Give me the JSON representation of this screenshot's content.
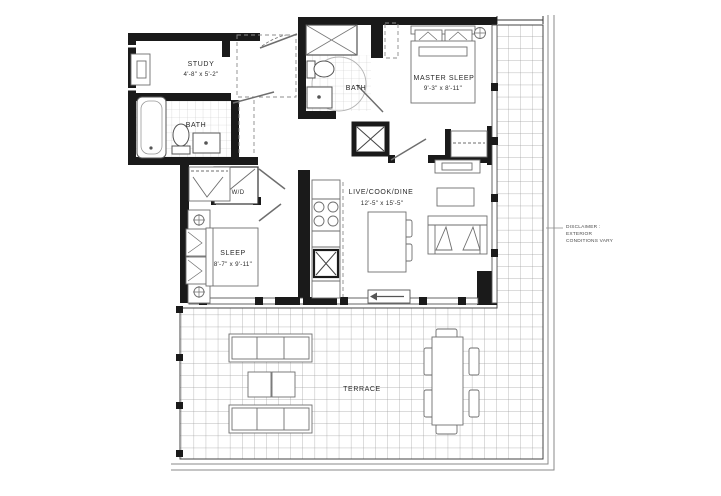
{
  "rooms": {
    "study": {
      "name": "STUDY",
      "dims": "4'-8\" x 5'-2\""
    },
    "bath1": {
      "name": "BATH"
    },
    "bath2": {
      "name": "BATH"
    },
    "master": {
      "name": "MASTER SLEEP",
      "dims": "9'-3\" x 8'-11\""
    },
    "sleep": {
      "name": "SLEEP",
      "dims": "8'-7\" x 9'-11\""
    },
    "living": {
      "name": "LIVE/COOK/DINE",
      "dims": "12'-5\" x 15'-5\""
    },
    "laundry": {
      "name": "W/D"
    },
    "terrace": {
      "name": "TERRACE"
    }
  },
  "disclaimer": {
    "line1": "DISCLAIMER :",
    "line2": "EXTERIOR",
    "line3": "CONDITIONS VARY"
  },
  "colors": {
    "wall": "#1a1a1a",
    "furniture_line": "#6e6e6e",
    "bath_tile": "#c9c9c9",
    "terrace_tile": "#9f9f9f",
    "text": "#2a2a2a"
  }
}
